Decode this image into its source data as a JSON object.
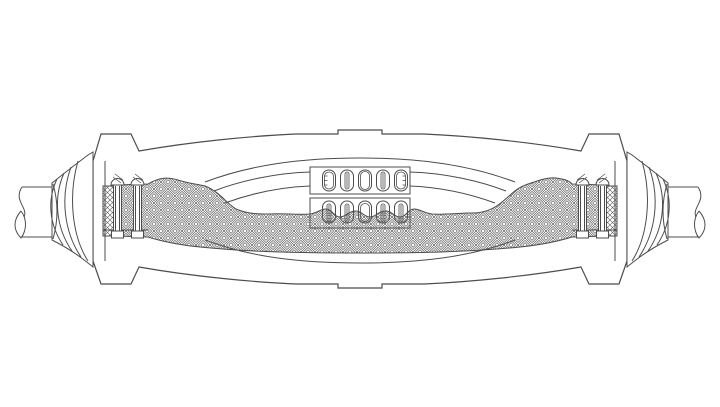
{
  "diagram": {
    "kind": "engineering-line-drawing",
    "subject": "cable-joint-splice-cutaway",
    "background": "#ffffff",
    "line_color": "#4c4c4c",
    "pattern_line_color": "#5a5a5a",
    "fill_color": "#ffffff",
    "connector_bolt_slots_per_block": 5,
    "connector_blocks": 2,
    "clamp_studs_per_side": 2,
    "components": [
      "outer-shell",
      "alignment-tab-top",
      "alignment-tab-bottom",
      "cable-left",
      "cable-right",
      "sealing-boot-left",
      "sealing-boot-right",
      "shield-clamp-left",
      "shield-clamp-right",
      "braid-shield",
      "core-insulation-layers",
      "connector-block-upper",
      "connector-block-lower"
    ]
  }
}
